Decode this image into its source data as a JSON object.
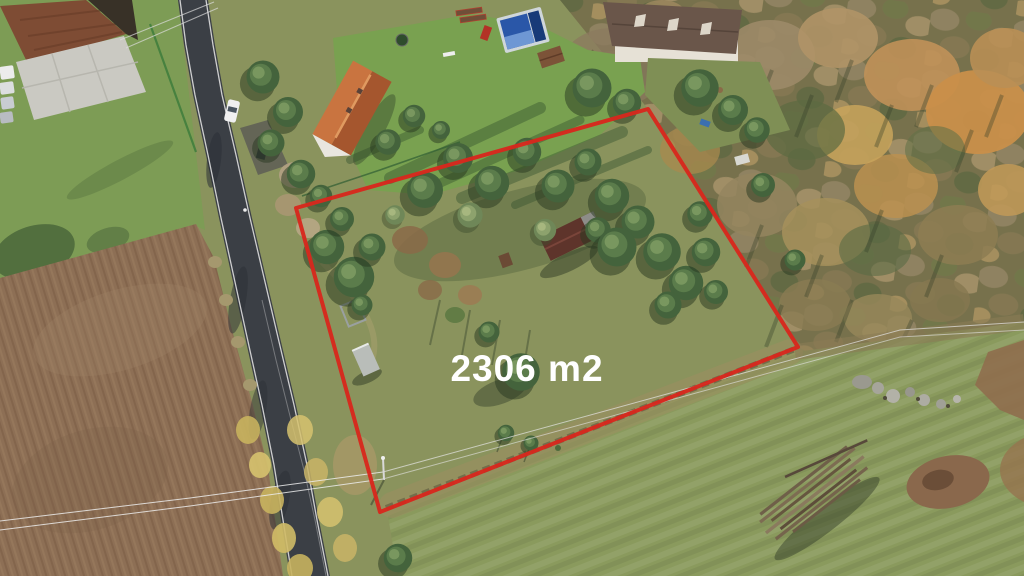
{
  "overlay": {
    "area_label": "2306 m2",
    "boundary_points": "296,208 648,109 798,347 380,512",
    "boundary_color": "#d7281d",
    "label_color": "#ffffff"
  },
  "palette": {
    "grass": "#8a935d",
    "road": "#3b3f45",
    "field": "#8d6f55",
    "lawn": "#79a150",
    "woodland": "#77714c",
    "meadow": "#8a9a5d"
  }
}
